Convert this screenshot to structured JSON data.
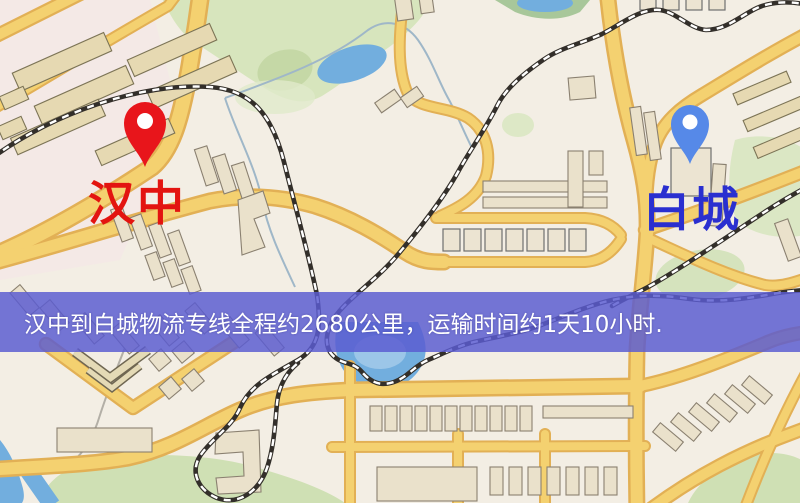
{
  "map": {
    "origin": {
      "name": "汉中",
      "pin_color": "#e8151b",
      "label_color": "#e31410"
    },
    "destination": {
      "name": "白城",
      "pin_color": "#5689e8",
      "label_color": "#2a2fd0"
    },
    "banner": {
      "text": "汉中到白城物流专线全程约2680公里，运输时间约1天10小时.",
      "background_color": "#5a5cd0",
      "text_color": "#ffffff"
    },
    "palette": {
      "background": "#f3eee4",
      "road": "#f4d170",
      "road_casing": "#e2b055",
      "park": "#d7e5bd",
      "water": "#72aede",
      "building": "#eae1cb",
      "railway": "#332f2a"
    }
  }
}
